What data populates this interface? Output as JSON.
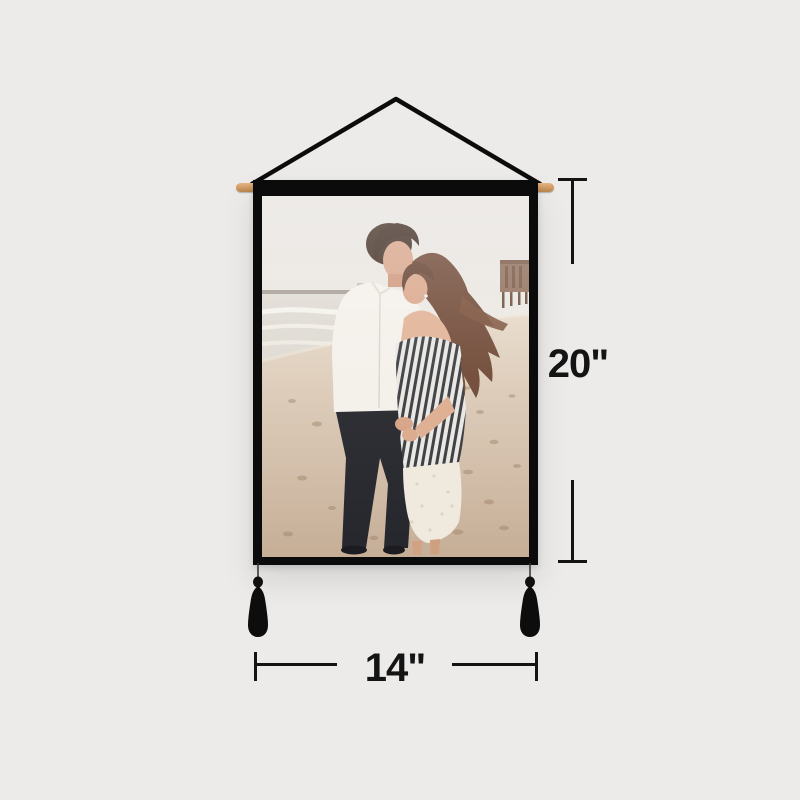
{
  "image": {
    "type": "product-photo",
    "background_color": "#ECEBE9"
  },
  "product": {
    "item": "hanging-poster-tapestry",
    "frame_color": "#0B0B0B",
    "rod_color": "#D9A770",
    "string_color": "#0C0C0C",
    "tassel_color": "#0D0D0D",
    "photo_subject": "couple-embracing-on-beach-with-ocean-and-pier"
  },
  "dimensions": {
    "height_label": "20\"",
    "width_label": "14\"",
    "line_color": "#141414"
  }
}
